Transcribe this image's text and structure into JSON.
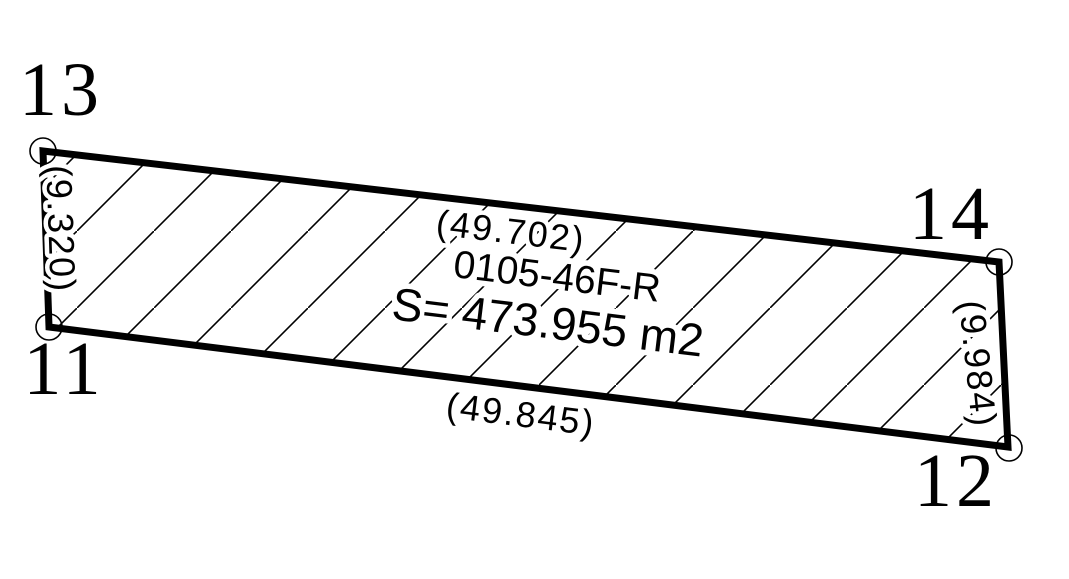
{
  "parcel": {
    "id": "0105-46F-R",
    "area_label": "S= 473.955 m2"
  },
  "dimensions": {
    "top": "(49.702)",
    "bottom": "(49.845)",
    "left": "(9.320)",
    "right": "(9.984)"
  },
  "corner_points": {
    "top_left": "13",
    "top_right": "14",
    "bottom_left": "11",
    "bottom_right": "12"
  },
  "colors": {
    "ink": "#000000",
    "paper": "#ffffff"
  }
}
